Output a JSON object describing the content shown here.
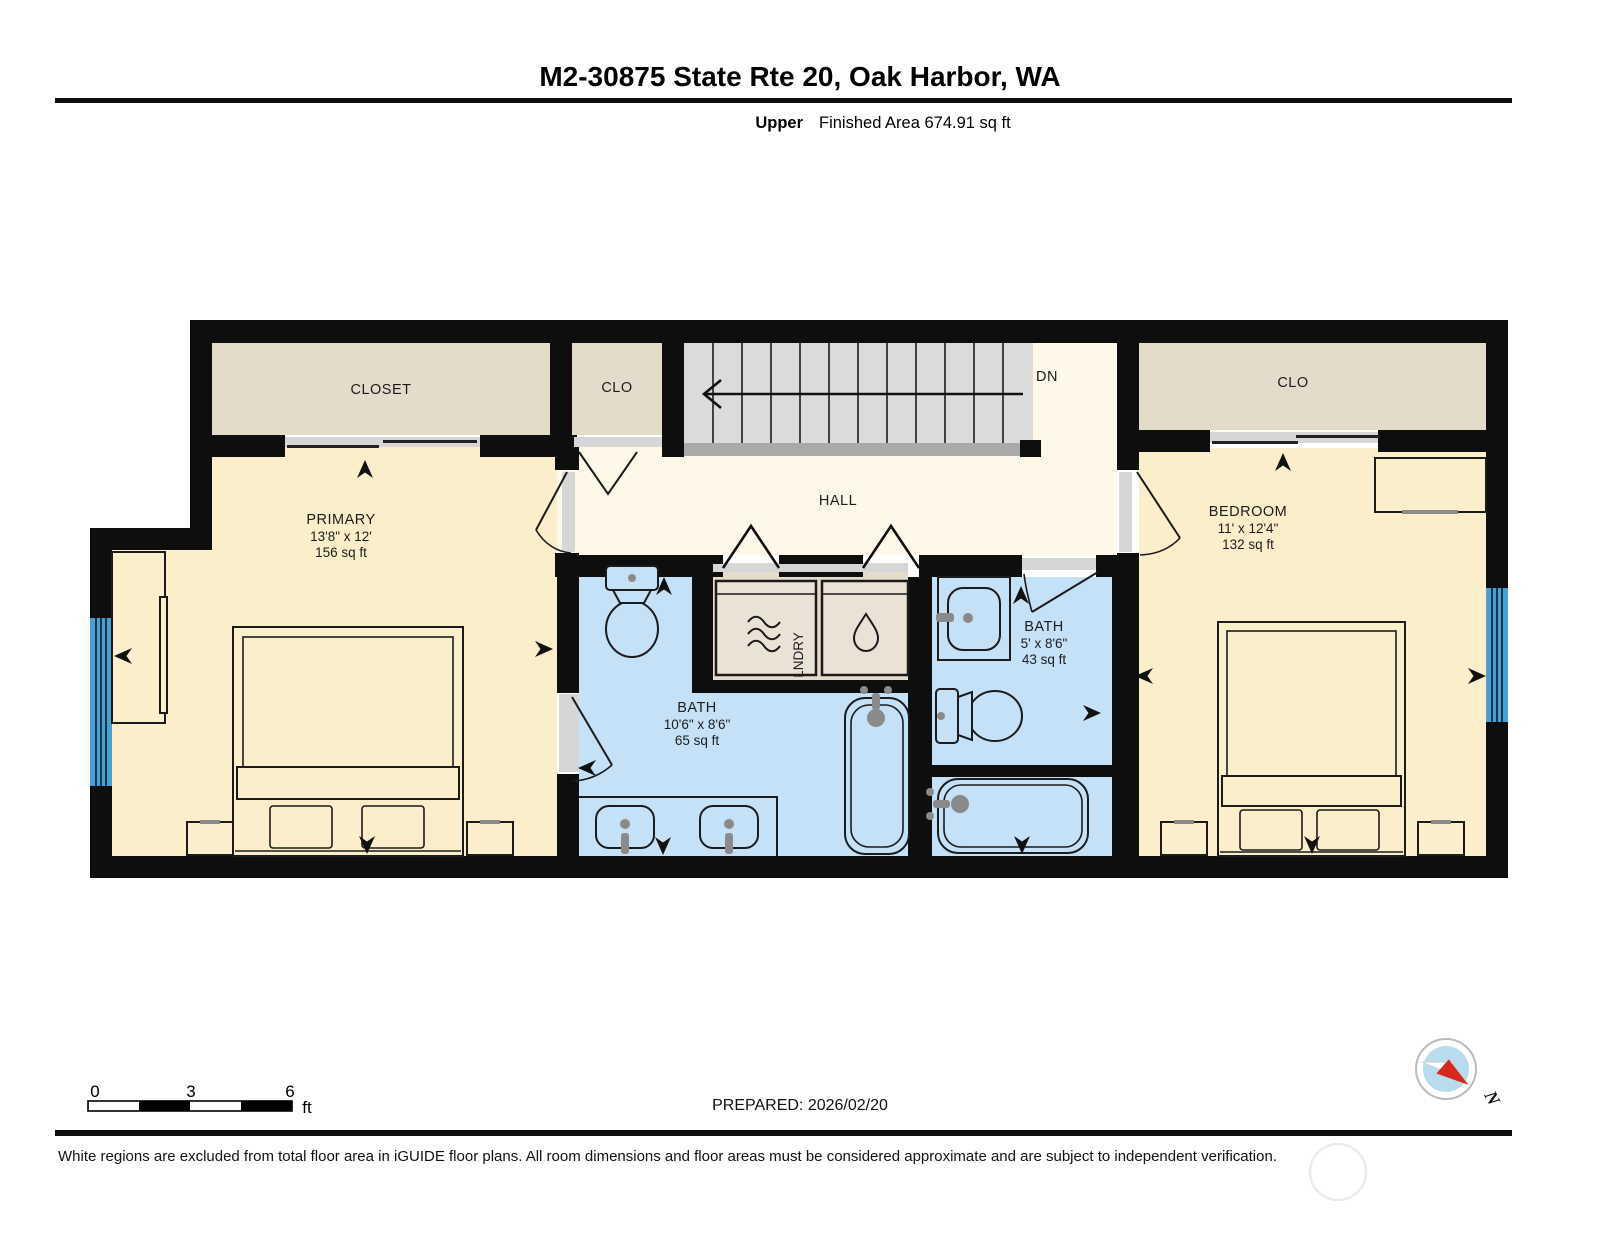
{
  "header": {
    "title": "M2-30875 State Rte 20, Oak Harbor, WA",
    "floor_label": "Upper",
    "area_label": "Finished Area 674.91 sq ft"
  },
  "rooms": {
    "closet_left": {
      "label": "CLOSET"
    },
    "clo_mid": {
      "label": "CLO"
    },
    "clo_right": {
      "label": "CLO"
    },
    "stairs": {
      "label": "DN"
    },
    "hall": {
      "label": "HALL"
    },
    "primary": {
      "name": "PRIMARY",
      "dims": "13'8\" x 12'",
      "area": "156 sq ft"
    },
    "bedroom": {
      "name": "BEDROOM",
      "dims": "11' x 12'4\"",
      "area": "132 sq ft"
    },
    "bath_main": {
      "name": "BATH",
      "dims": "10'6\" x 8'6\"",
      "area": "65 sq ft"
    },
    "bath_small": {
      "name": "BATH",
      "dims": "5' x 8'6\"",
      "area": "43 sq ft"
    },
    "laundry": {
      "label": "LNDRY"
    }
  },
  "scale_bar": {
    "tick0": "0",
    "tick3": "3",
    "tick6": "6",
    "unit": "ft"
  },
  "footer": {
    "prepared": "PREPARED: 2026/02/20",
    "compass_label": "N",
    "disclaimer": "White regions are excluded from total floor area in iGUIDE floor plans. All room dimensions and floor areas must be considered approximate and are subject to independent verification."
  },
  "colors": {
    "room_yellow": "#faeecb",
    "hall_cream": "#fdf8e7",
    "closet_beige": "#e4dccb",
    "bath_blue": "#c4e1f8",
    "stairs_gray": "#dbdbdb",
    "window_blue": "#4c9fd2",
    "wall_black": "#0e0e0e",
    "compass_red": "#d42a1e"
  }
}
